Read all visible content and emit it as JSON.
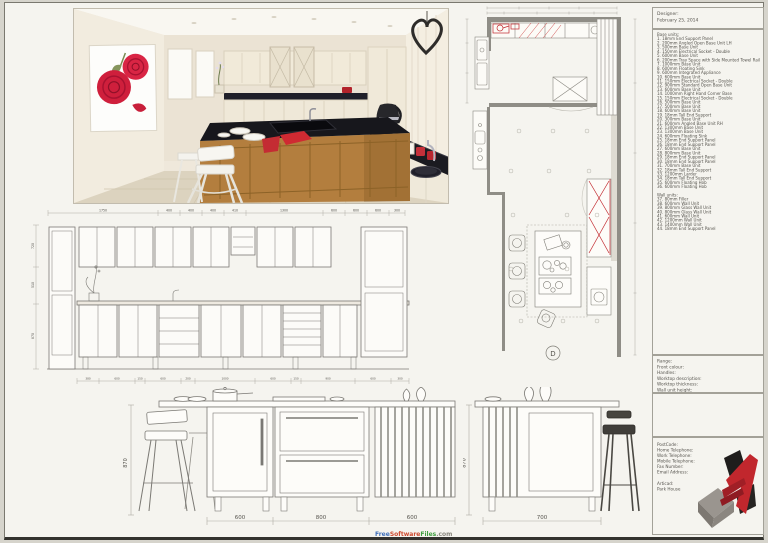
{
  "designer_box": {
    "designer_label": "Designer:",
    "date": "February 25, 2014"
  },
  "units_box": {
    "base_title": "Base units:",
    "base_items": [
      "1. 18mm End Support Panel",
      "2. 200mm Angled Open Base Unit LH",
      "3. 500mm Base Unit",
      "4. 150mm Electrical Socket - Double",
      "5. 600mm Base Unit",
      "6. 200mm Tray Space with Side Mounted Towel Rail",
      "7. 1000mm Base Unit",
      "8. 600mm Floating Sink",
      "9. 600mm Integrated Appliance",
      "10. 600mm Base Unit",
      "11. 150mm Electrical Socket - Double",
      "12. 900mm Standard Open Base Unit",
      "13. 600mm Base Unit",
      "14. 1000mm Right Hand Corner Base",
      "15. 150mm Electrical Socket - Double",
      "16. 500mm Base Unit",
      "17. 500mm Base Unit",
      "18. 600mm Base Unit",
      "19. 18mm Tall End Support",
      "20. 300mm Base Unit",
      "21. 600mm Angled Base Unit RH",
      "22. 1300mm Base Unit",
      "23. 1300mm Base Unit",
      "24. 600mm Floating Sink",
      "25. 18mm End Support Panel",
      "26. 18mm End Support Panel",
      "27. 600mm Base Unit",
      "28. 800mm Base Unit",
      "29. 18mm End Support Panel",
      "30. 18mm End Support Panel",
      "31. 700mm Base Unit",
      "32. 18mm Tall End Support",
      "33. 1200mm Larder",
      "34. 18mm Tall End Support",
      "35. 600mm Floating Hob",
      "36. 600mm Floating Hob"
    ],
    "wall_title": "Wall units:",
    "wall_items": [
      "37. 80mm Filler",
      "38. 600mm Wall Unit",
      "39. 800mm Glass Wall Unit",
      "40. 800mm Glass Wall Unit",
      "41. 600mm Wall Unit",
      "42. 1200mm Wall Unit",
      "43. 1400mm Wall Unit",
      "44. 18mm End Support Panel"
    ]
  },
  "spec_box": {
    "labels": [
      "Range:",
      "Front colour:",
      "Handles:",
      "Worktop description:",
      "Worktop thickness:",
      "Wall unit height:"
    ]
  },
  "contact_box": {
    "labels": [
      "PostCode:",
      "Home Telephone:",
      "Work Telephone:",
      "Mobile Telephone:",
      "Fax Number:",
      "Email Address:"
    ],
    "brand_label": "Articad:",
    "project_name": "Park House"
  },
  "watermark": {
    "free": "Free",
    "software": "Software",
    "files": "Files",
    "dotcom": ".com"
  },
  "elevation": {
    "top_dims": [
      "1750",
      "400",
      "400",
      "400",
      "410",
      "1300",
      "600",
      "600",
      "600",
      "300"
    ],
    "bottom_dims": [
      "380",
      "600",
      "150",
      "600",
      "200",
      "1000",
      "600",
      "150",
      "900",
      "600",
      "300"
    ],
    "left_dims": [
      "720",
      "510",
      "870"
    ]
  },
  "island_left": {
    "width_dims": [
      "600",
      "800",
      "600"
    ],
    "height_dim": "870"
  },
  "island_right": {
    "width_dim": "700",
    "height_dim": "870"
  },
  "floor_plan": {
    "detail_label": "D"
  },
  "colors": {
    "accent_red": "#c1272d",
    "granite_black": "#1b1b21",
    "island_wood": "#b37e3e",
    "paper": "#f5f4ef"
  }
}
